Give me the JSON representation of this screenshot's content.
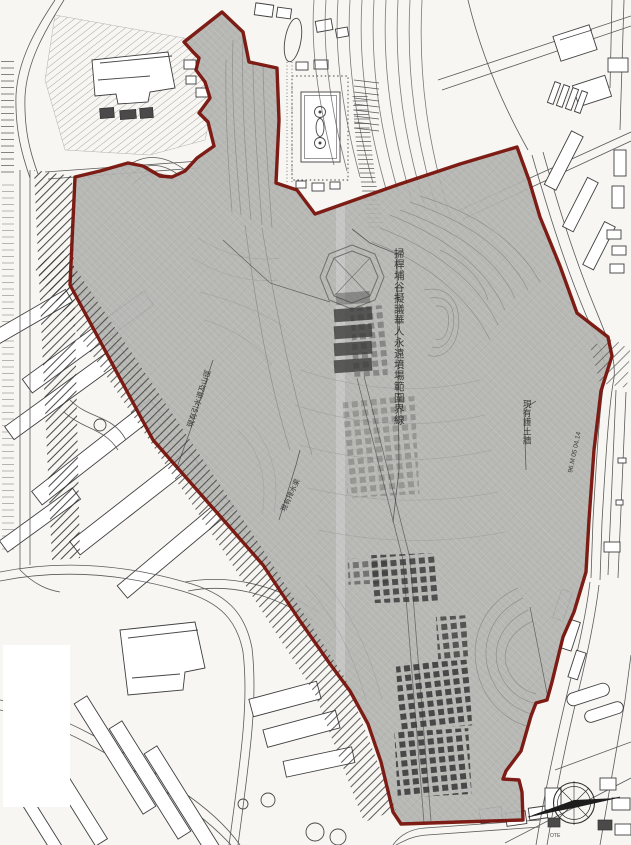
{
  "map": {
    "title_hint": "scanned survey plan with outlined study area",
    "colors": {
      "paper": "#f7f6f2",
      "region_fill": "#b1b1af",
      "boundary_red": "#77120b",
      "hatch_ink": "#2e2e2e",
      "line_ink": "#5a5a5a",
      "annotation_ink": "#1f1f1f"
    },
    "region": {
      "boundary_points": "222,12 243,32 249,62 277,68 279,120 276,183 297,190 315,214 400,184 460,164 517,147 529,180 540,217 560,266 577,313 608,337 612,356 601,391 594,450 589,520 586,572 574,612 563,637 552,682 547,700 536,703 531,716 521,751 506,771 503,779 519,780 522,792 523,820 460,822 401,824 393,812 381,762 368,724 350,691 330,664 300,621 263,565 153,440 70,285 75,177 100,171 128,163 143,166 160,176 172,177 185,171 197,158 214,146 208,122 199,113 210,98 205,82 196,70 199,58 193,52 184,42"
    },
    "grave_clusters": [
      {
        "x": 348,
        "y": 558,
        "w": 40,
        "h": 26,
        "rot": -2,
        "opacity": 0.55
      },
      {
        "x": 372,
        "y": 554,
        "w": 66,
        "h": 48,
        "rot": -2,
        "opacity": 0.85
      },
      {
        "x": 437,
        "y": 616,
        "w": 30,
        "h": 44,
        "rot": -3,
        "opacity": 0.8
      },
      {
        "x": 398,
        "y": 662,
        "w": 72,
        "h": 66,
        "rot": -4,
        "opacity": 0.9
      },
      {
        "x": 396,
        "y": 730,
        "w": 74,
        "h": 66,
        "rot": -3,
        "opacity": 0.9
      },
      {
        "x": 345,
        "y": 398,
        "w": 72,
        "h": 98,
        "rot": -3,
        "opacity": 0.28
      },
      {
        "x": 352,
        "y": 306,
        "w": 34,
        "h": 70,
        "rot": -3,
        "opacity": 0.4
      }
    ],
    "annotations": [
      {
        "id": "boundary-note",
        "mode": "vertical",
        "x": 394,
        "y": 257,
        "size": 10.5,
        "text": "掃桿埔谷擬議華人永遠墳場範圍界線",
        "leader": "352,229 370,243 397,254 399,470 393,522"
      },
      {
        "id": "west-slope-note",
        "mode": "diagonal",
        "x": 192,
        "y": 428,
        "angle": -72,
        "size": 7.5,
        "text": "現有引水道及山徑",
        "leader": "176,470 190,431 213,360"
      },
      {
        "id": "mid-slope-note",
        "mode": "diagonal",
        "x": 285,
        "y": 512,
        "angle": -65,
        "size": 7,
        "text": "現有排水渠",
        "leader": "279,520 296,465 300,450"
      },
      {
        "id": "east-wall-note",
        "mode": "vertical",
        "x": 523,
        "y": 407,
        "size": 8.5,
        "text": "現有護土牆",
        "leader": "536,401 524,409 526,470"
      },
      {
        "id": "road-ref-note",
        "mode": "diagonal",
        "x": 572,
        "y": 473,
        "angle": -78,
        "size": 6.5,
        "text": "96.M 05 04.14",
        "leader": ""
      },
      {
        "id": "corner-micro-label",
        "mode": "horizontal",
        "x": 550,
        "y": 837,
        "size": 5,
        "text": "OTE",
        "leader": ""
      }
    ],
    "compass": {
      "icon": "north-arrow-compass-rose"
    }
  }
}
